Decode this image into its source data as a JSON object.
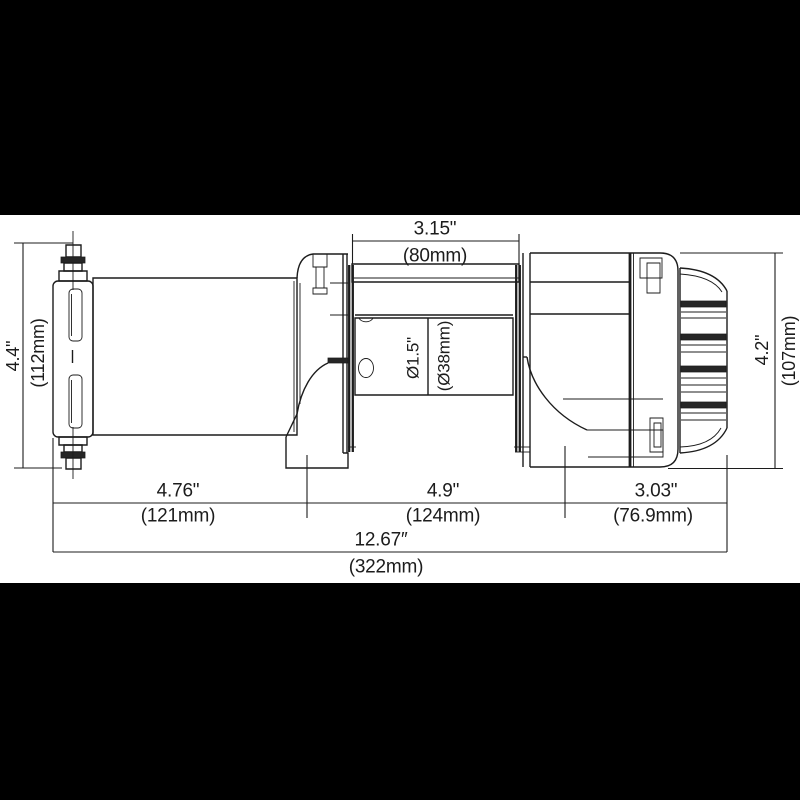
{
  "drawing": {
    "kind": "technical-dimension-diagram",
    "subject": "electric winch side view"
  },
  "colors": {
    "letterbox": "#000000",
    "paper": "#ffffff",
    "ink": "#1c1c1c"
  },
  "dimensions": {
    "top": {
      "in": "3.15\"",
      "mm": "(80mm)"
    },
    "left": {
      "in": "4.4\"",
      "mm": "(112mm)"
    },
    "right": {
      "in": "4.2\"",
      "mm": "(107mm)"
    },
    "drum": {
      "in": "Ø1.5\"",
      "mm": "(Ø38mm)"
    },
    "bottom_left": {
      "in": "4.76\"",
      "mm": "(121mm)"
    },
    "bottom_center": {
      "in": "4.9\"",
      "mm": "(124mm)"
    },
    "bottom_right": {
      "in": "3.03\"",
      "mm": "(76.9mm)"
    },
    "overall": {
      "in": "12.67″",
      "mm": "(322mm)"
    }
  }
}
